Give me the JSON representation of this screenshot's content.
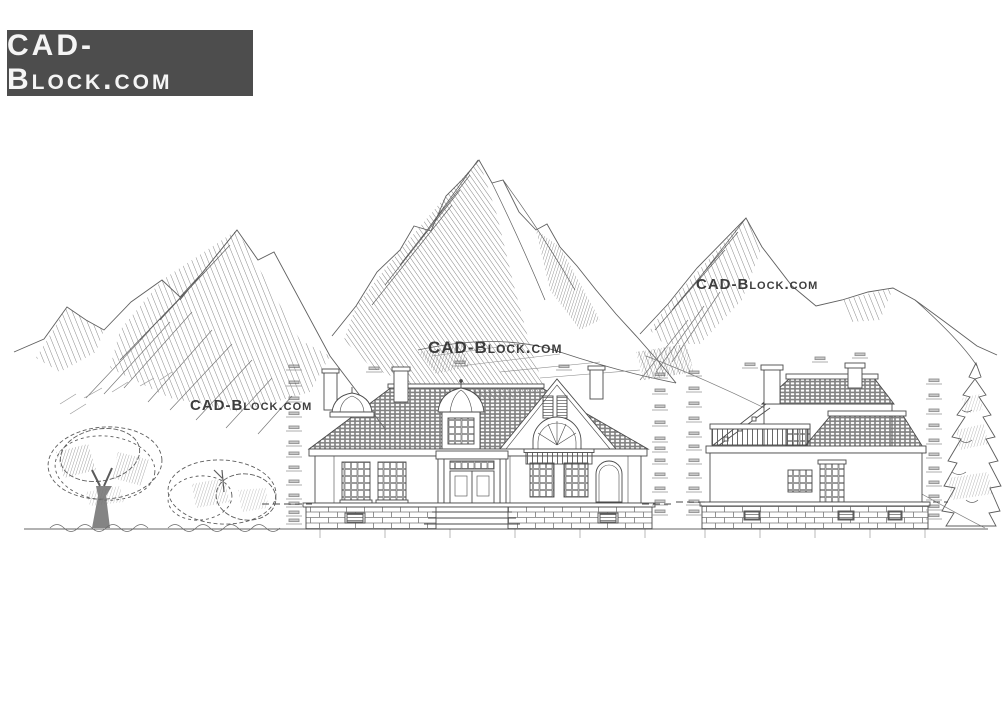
{
  "page": {
    "background": "#ffffff"
  },
  "logo": {
    "text": "CAD-Block.com",
    "background": "#4d4d4d",
    "color": "#f5f5f5"
  },
  "watermarks": [
    {
      "text": "CAD-Block.com"
    },
    {
      "text": "CAD-Block.com"
    },
    {
      "text": "CAD-Block.com"
    }
  ],
  "palette": {
    "ink": "#4a4a4a",
    "mountain_ink": "#5f5f5f",
    "hatch_ink": "#6b6b6b",
    "light_ink": "#8f8f8f",
    "tick_ink": "#9a9a9a"
  },
  "scene": {
    "elements": [
      "mountain-range-left",
      "mountain-peak-center",
      "mountain-range-right",
      "deciduous-tree",
      "bush",
      "conifer-tree",
      "house-front-elevation",
      "house-side-elevation",
      "ground-line"
    ]
  }
}
